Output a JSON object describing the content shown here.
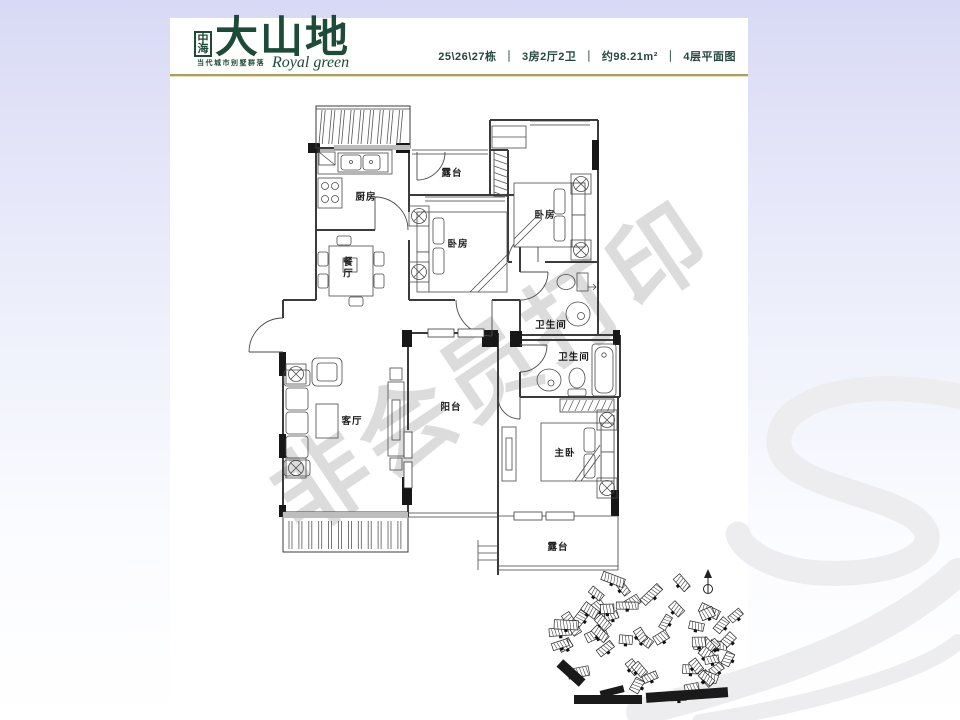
{
  "colors": {
    "brand_green": "#1e4a38",
    "gold_rule": "#ab9d62",
    "watermark_gray": "#b9b9b9"
  },
  "header": {
    "logo": {
      "mark": "中海",
      "name": "大山地",
      "tagline": "当代城市别墅群落",
      "script_name": "Royal green"
    },
    "info": {
      "building": "25\\26\\27栋",
      "separator": "｜",
      "layout": "3房2厅2卫",
      "area": "约98.21m²",
      "floor_plan": "4层平面图"
    }
  },
  "watermark": {
    "text": "非会员打印"
  },
  "floor_plan": {
    "rooms": [
      {
        "label": "露台",
        "x": 452,
        "y": 172,
        "vertical": false
      },
      {
        "label": "厨房",
        "x": 366,
        "y": 196,
        "vertical": false
      },
      {
        "label": "卧房",
        "x": 545,
        "y": 214,
        "vertical": false
      },
      {
        "label": "卧房",
        "x": 458,
        "y": 243,
        "vertical": false
      },
      {
        "label": "餐厅",
        "x": 346,
        "y": 268,
        "vertical": true
      },
      {
        "label": "卫生间",
        "x": 551,
        "y": 324,
        "vertical": false
      },
      {
        "label": "卫生间",
        "x": 574,
        "y": 356,
        "vertical": false
      },
      {
        "label": "客厅",
        "x": 352,
        "y": 420,
        "vertical": false
      },
      {
        "label": "阳台",
        "x": 451,
        "y": 406,
        "vertical": false
      },
      {
        "label": "主卧",
        "x": 565,
        "y": 452,
        "vertical": false
      },
      {
        "label": "露台",
        "x": 558,
        "y": 546,
        "vertical": false
      }
    ]
  }
}
